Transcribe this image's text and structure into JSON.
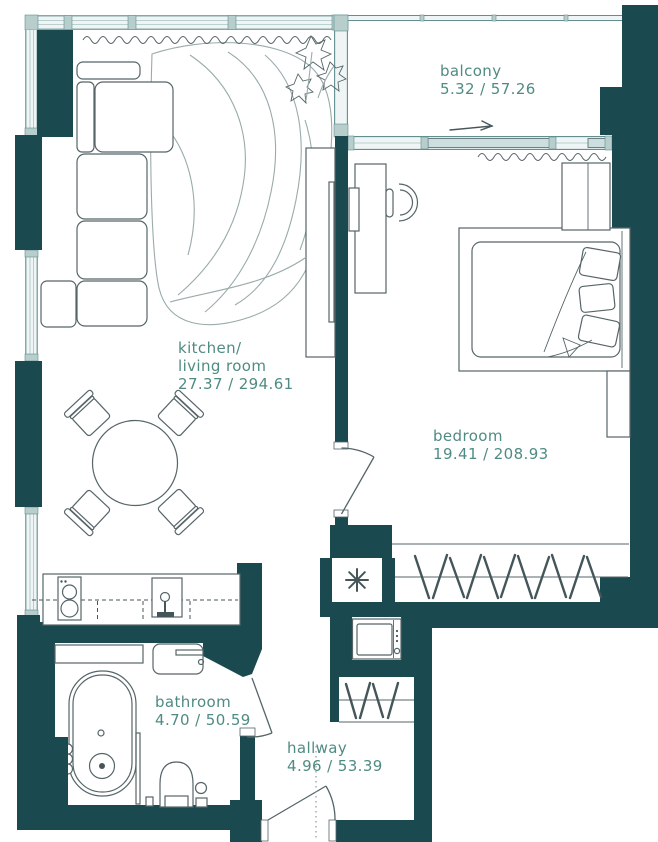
{
  "rooms": {
    "balcony": {
      "name": "balcony",
      "area": "5.32 / 57.26"
    },
    "kitchen_living": {
      "name_line1": "kitchen/",
      "name_line2": "living room",
      "area": "27.37 / 294.61"
    },
    "bedroom": {
      "name": "bedroom",
      "area": "19.41 / 208.93"
    },
    "bathroom": {
      "name": "bathroom",
      "area": "4.70 / 50.59"
    },
    "hallway": {
      "name": "hallway",
      "area": "4.96 / 53.39"
    }
  },
  "colors": {
    "wall": "#1a4a50",
    "label": "#4f8b83",
    "line": "#566568",
    "frame": "#628e92",
    "glass": "#eff5f4",
    "panel": "#ccdedd",
    "mullion": "#b7cecd",
    "rug": "#9aabab",
    "dash": "#45565a"
  }
}
